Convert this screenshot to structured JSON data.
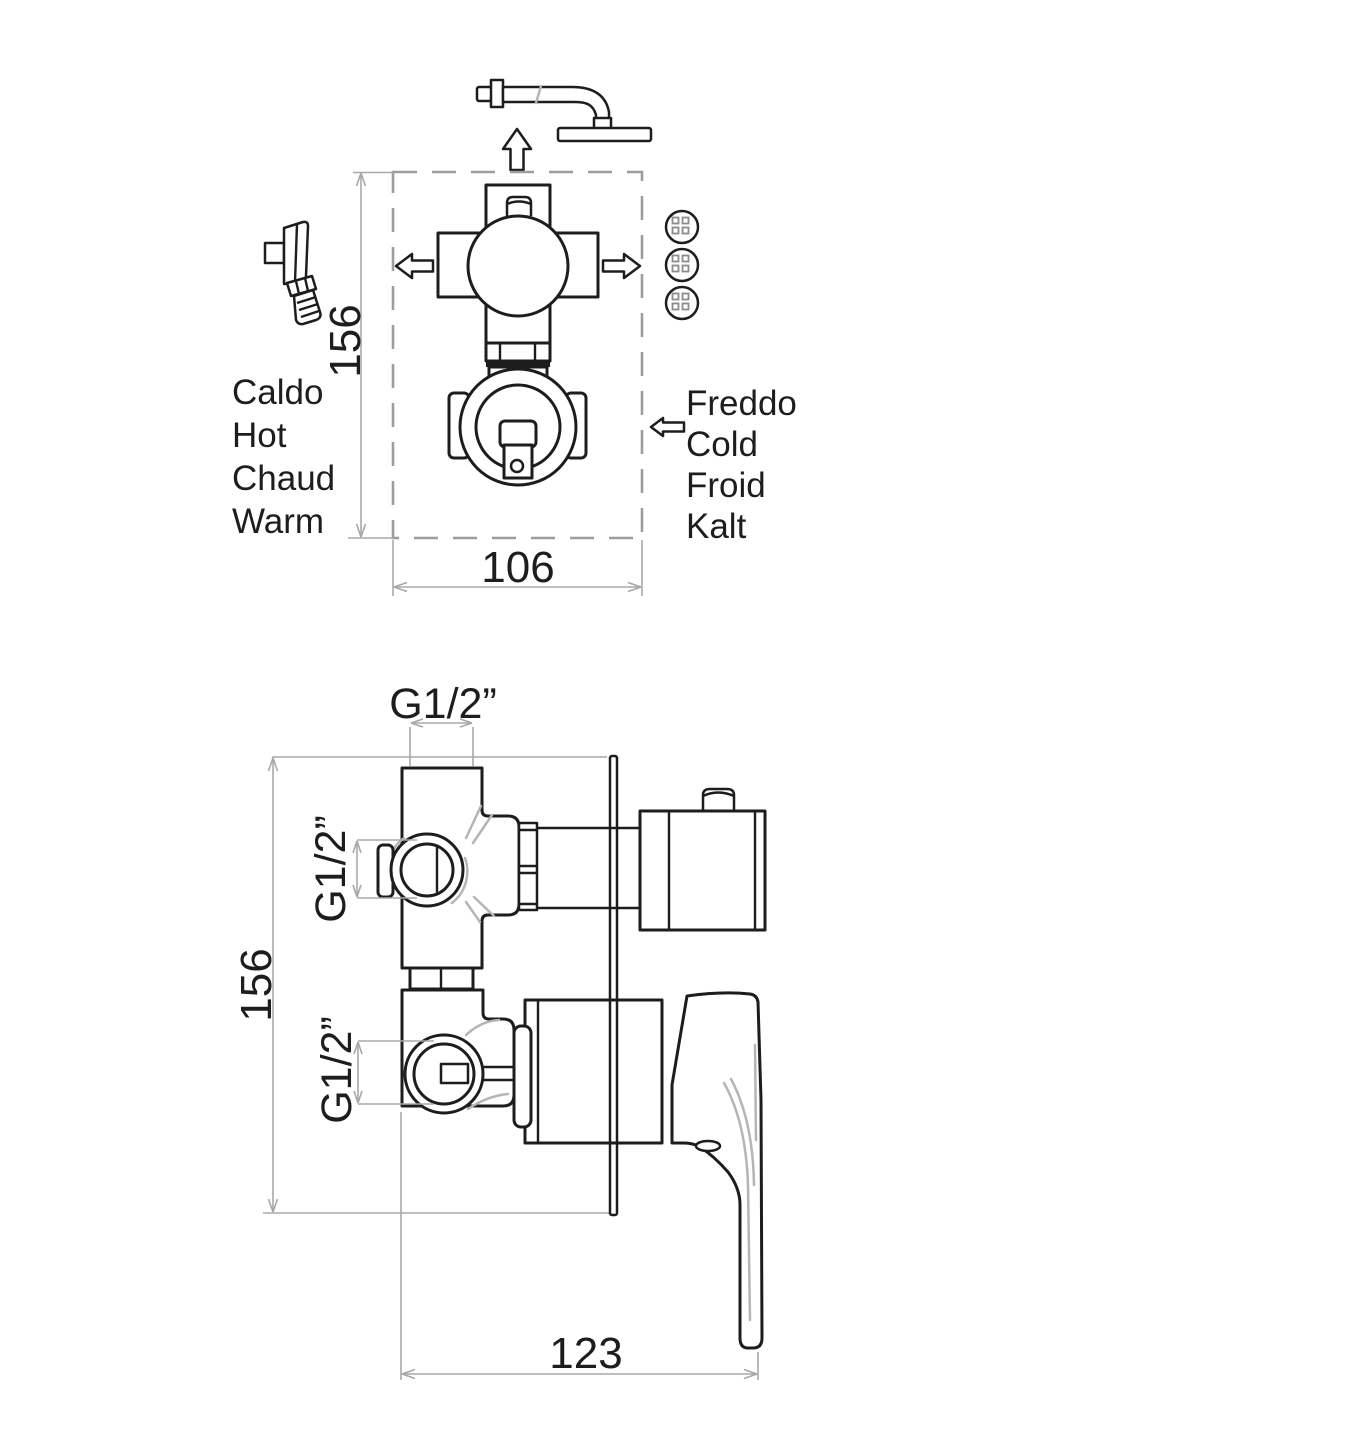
{
  "top_view": {
    "hot_labels": [
      "Caldo",
      "Hot",
      "Chaud",
      "Warm"
    ],
    "cold_labels": [
      "Freddo",
      "Cold",
      "Froid",
      "Kalt"
    ],
    "height_dim": "156",
    "width_dim": "106"
  },
  "side_view": {
    "thread_top": "G1/2”",
    "thread_middle": "G1/2”",
    "thread_bottom": "G1/2”",
    "height_dim": "156",
    "width_dim": "123"
  },
  "icons": {
    "overhead_shower": "wall-arm-with-shower-head",
    "hand_shower": "hand-shower-on-wall-bracket",
    "function_buttons": "three-round-buttons-2x2-dots",
    "flow_arrows": "outline-directional-arrows"
  },
  "colors": {
    "line": "#1d1d1b",
    "dimension": "#a8a8a8",
    "dashed_box": "#9d9d9c",
    "accent": "#b5b5b5",
    "background": "#ffffff"
  }
}
